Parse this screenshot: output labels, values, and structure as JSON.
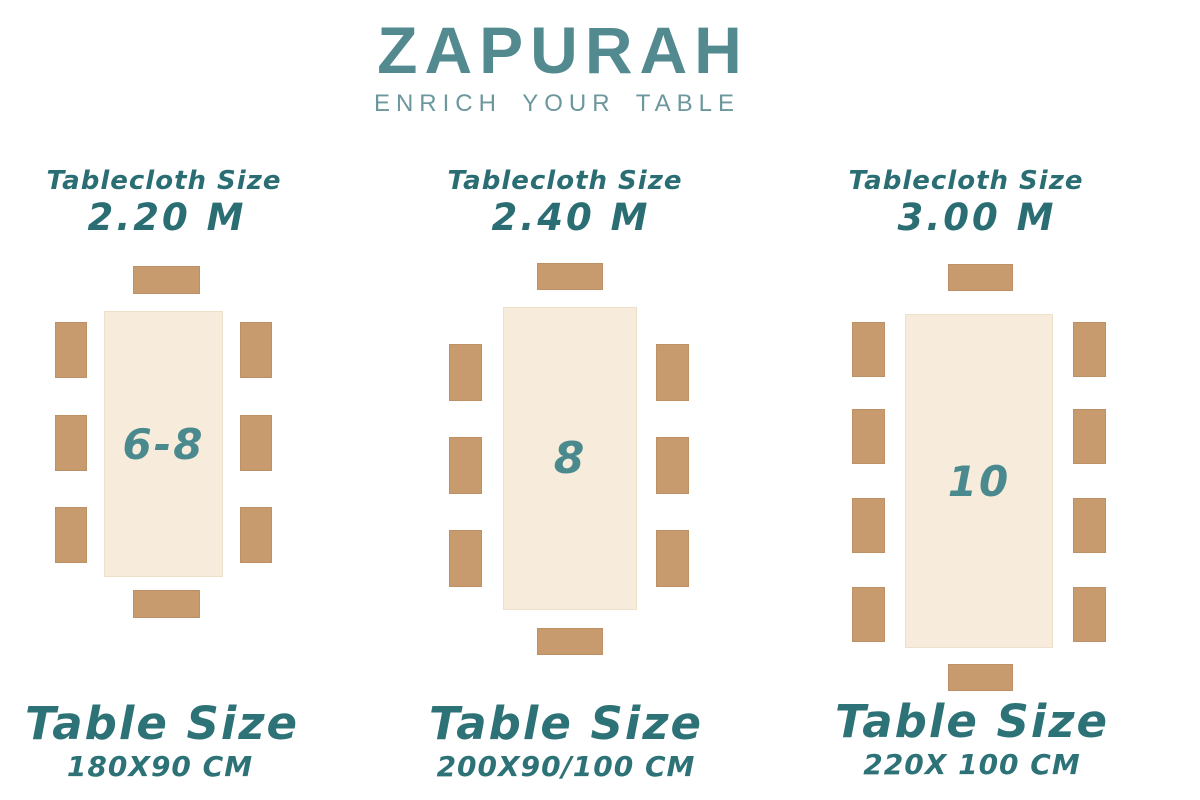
{
  "brand": {
    "name": "ZAPURAH",
    "tagline": "ENRICH YOUR TABLE"
  },
  "colors": {
    "logo_teal": "#538a90",
    "tagline_teal": "#6b979d",
    "label_teal": "#2a6e74",
    "seat_number_teal": "#4a8a8e",
    "table_cream": "#f7ebdb",
    "chair_tan": "#c79b6e",
    "background": "#ffffff"
  },
  "options": [
    {
      "tablecloth_label": "Tablecloth Size",
      "tablecloth_size": "2.20 M",
      "seats": "6-8",
      "chairs_total": 8,
      "side_chairs_per_side": 3,
      "table_size_label": "Table Size",
      "table_dimensions": "180X90 CM"
    },
    {
      "tablecloth_label": "Tablecloth Size",
      "tablecloth_size": "2.40 M",
      "seats": "8",
      "chairs_total": 8,
      "side_chairs_per_side": 3,
      "table_size_label": "Table Size",
      "table_dimensions": "200X90/100 CM"
    },
    {
      "tablecloth_label": "Tablecloth Size",
      "tablecloth_size": "3.00 M",
      "seats": "10",
      "chairs_total": 10,
      "side_chairs_per_side": 4,
      "table_size_label": "Table Size",
      "table_dimensions": "220X 100 CM"
    }
  ]
}
